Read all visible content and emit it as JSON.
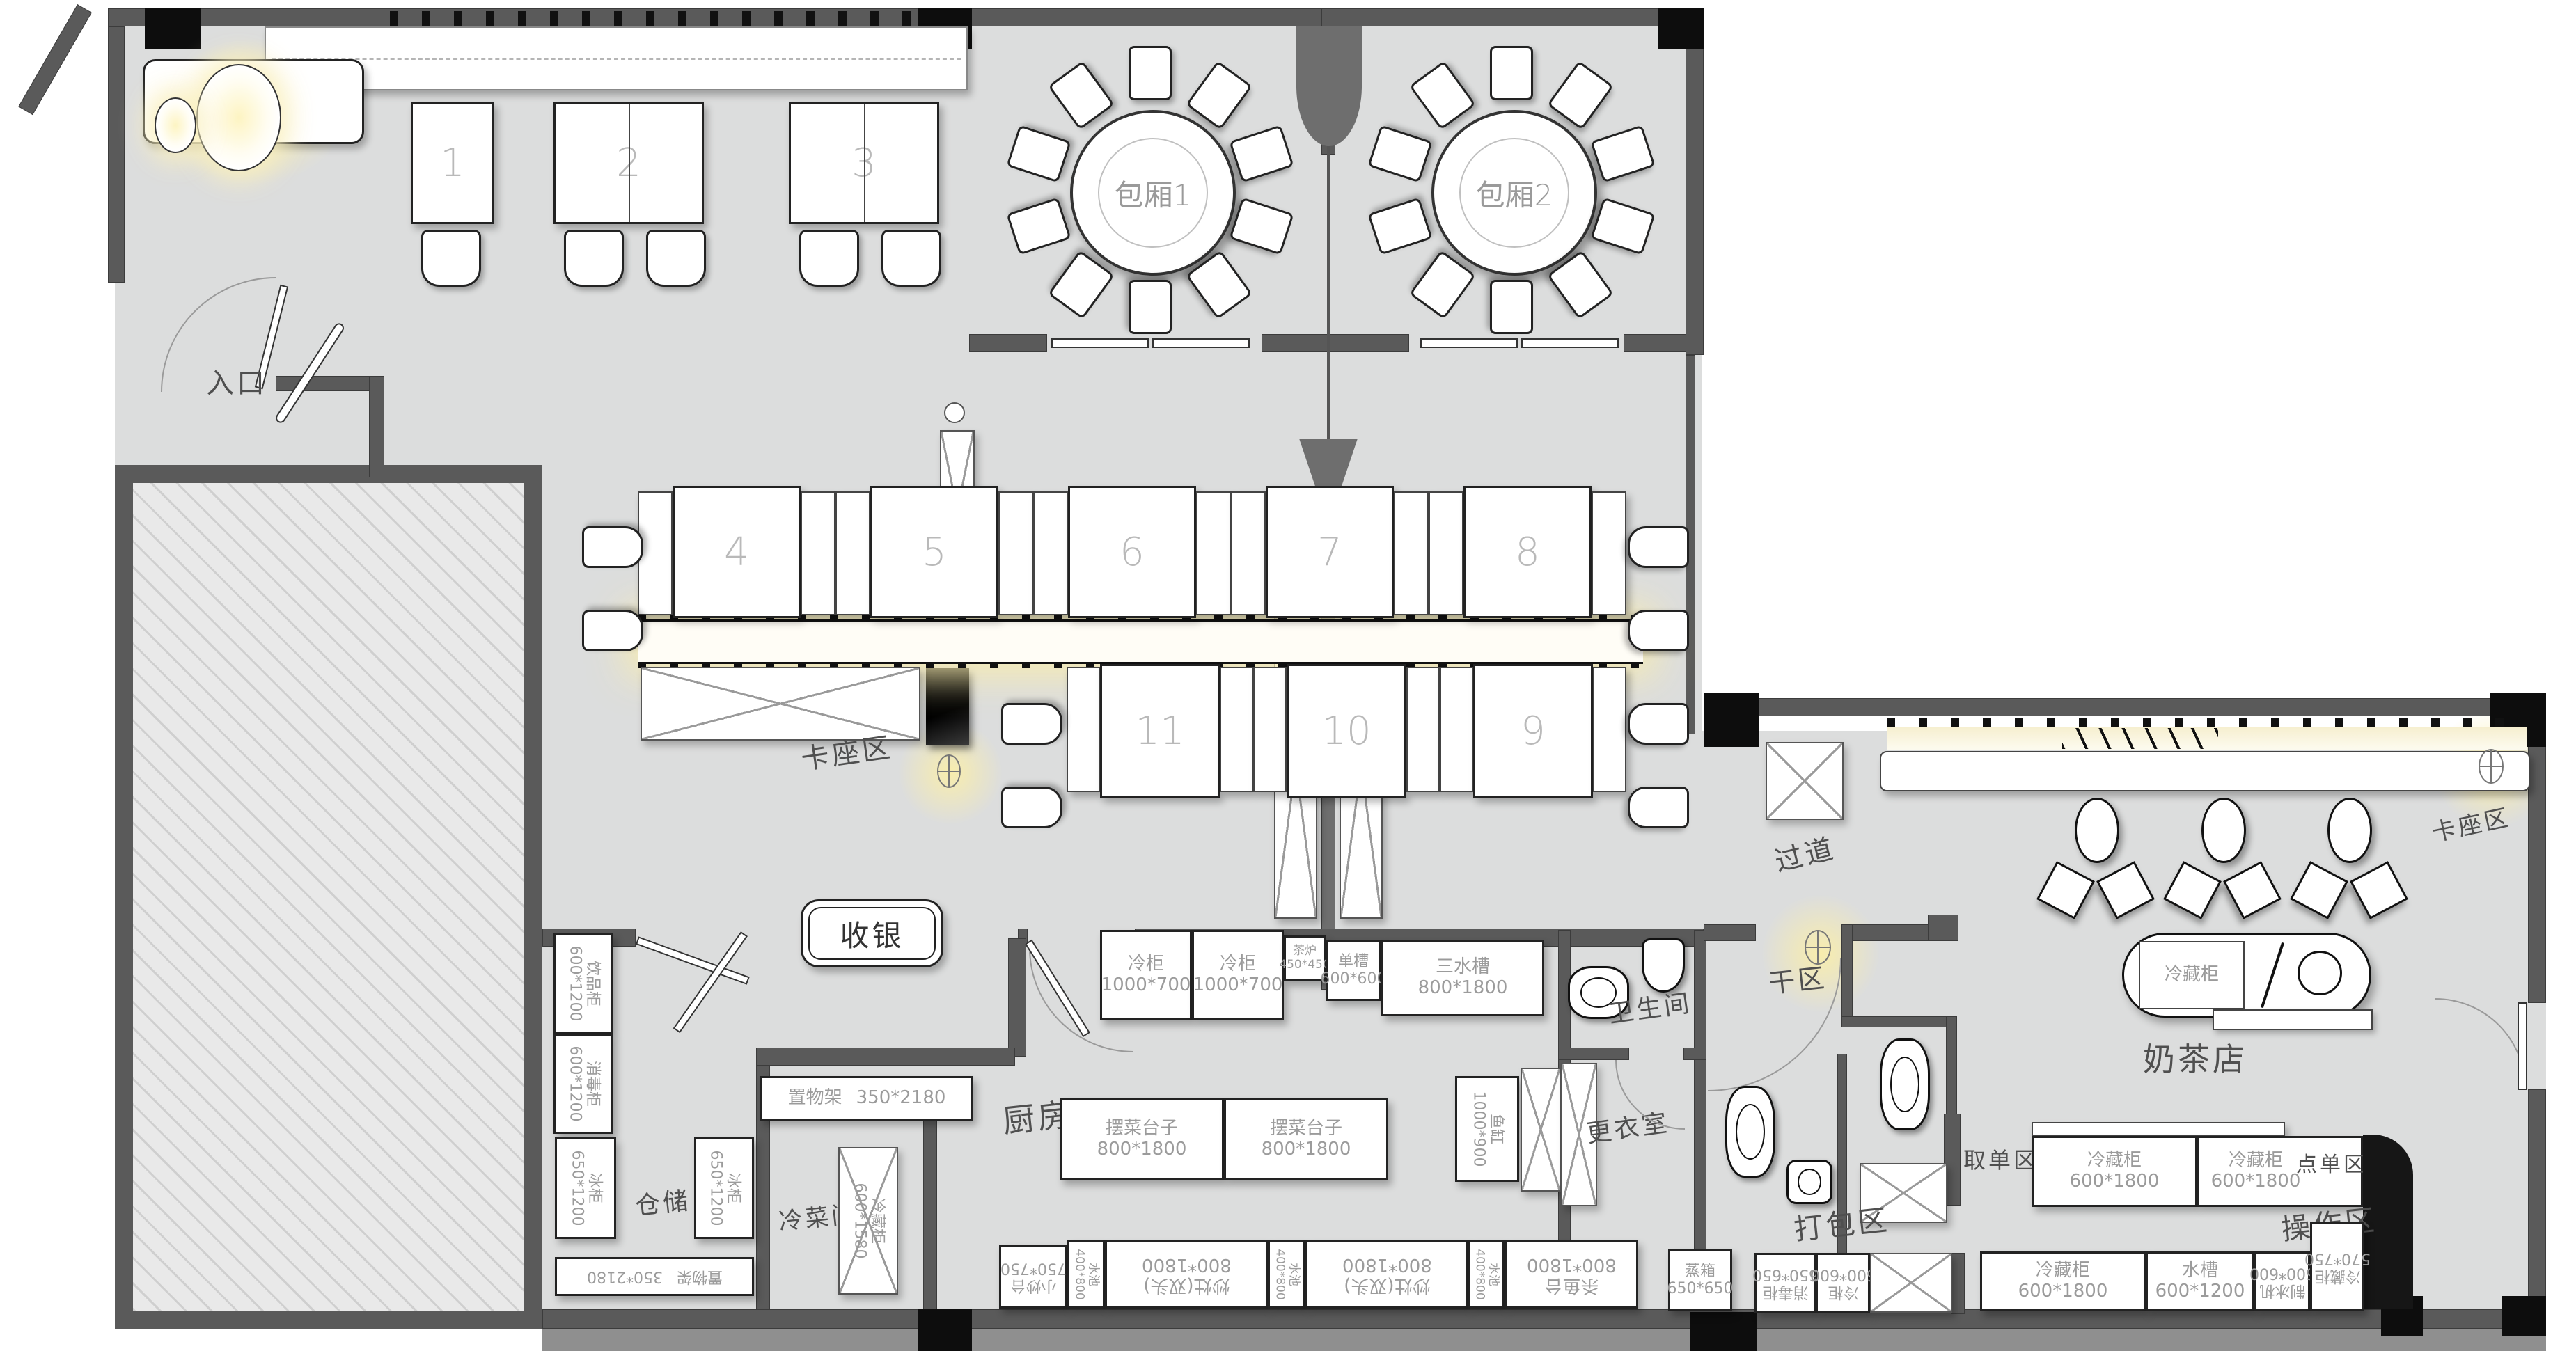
{
  "areas": {
    "entrance": "入口",
    "cashier": "收银",
    "booth_left": "卡座区",
    "booth_right": "卡座区",
    "corridor": "过道",
    "kitchen": "厨房",
    "storage": "仓储",
    "cold_dish_room": "冷菜间",
    "toilet": "卫生间",
    "changing_room": "更衣室",
    "dry_area": "干区",
    "milk_tea_shop": "奶茶店",
    "packing_area": "打包区",
    "operation_area": "操作区",
    "pickup_area": "取单区",
    "order_area": "点单区"
  },
  "private_rooms": {
    "room1": "包厢1",
    "room2": "包厢2"
  },
  "tables": {
    "t1": "1",
    "t2": "2",
    "t3": "3",
    "t4": "4",
    "t5": "5",
    "t6": "6",
    "t7": "7",
    "t8": "8",
    "t9": "9",
    "t10": "10",
    "t11": "11"
  },
  "equipment": {
    "cold_cab_a": {
      "label": "冷柜",
      "dims": "1000*700"
    },
    "cold_cab_b": {
      "label": "冷柜",
      "dims": "1000*700"
    },
    "tea_stove": {
      "label": "茶炉",
      "dims": "450*450"
    },
    "single_sink": {
      "label": "单槽",
      "dims": "600*600"
    },
    "triple_sink": {
      "label": "三水槽",
      "dims": "800*1800"
    },
    "shelf_kitchen": {
      "label": "置物架",
      "dims": "350*2180"
    },
    "plating_table_a": {
      "label": "摆菜台子",
      "dims": "800*1800"
    },
    "plating_table_b": {
      "label": "摆菜台子",
      "dims": "800*1800"
    },
    "fish_tank": {
      "label": "鱼缸",
      "dims": "1000*900"
    },
    "drink_cabinet": {
      "label": "饮品柜",
      "dims": "600*1200"
    },
    "disinfect_cab_storage": {
      "label": "消毒柜",
      "dims": "600*1200"
    },
    "freezer_a": {
      "label": "冰柜",
      "dims": "650*1200"
    },
    "freezer_b": {
      "label": "冰柜",
      "dims": "650*1200"
    },
    "shelf_storage": {
      "label": "置物架",
      "dims": "350*2180"
    },
    "cold_cab_colddish": {
      "label": "冷藏柜",
      "dims": "600*1580"
    },
    "stirfry_small": {
      "label": "小炒台",
      "dims": "750*750"
    },
    "sink_strip_a": {
      "label": "水池",
      "dims": "400*800"
    },
    "sink_strip_b": {
      "label": "水池",
      "dims": "400*800"
    },
    "sink_strip_c": {
      "label": "水池",
      "dims": "400*800"
    },
    "wok_stove_a": {
      "label": "炒灶(双头)",
      "dims": "800*1800"
    },
    "wok_stove_b": {
      "label": "炒灶(双头)",
      "dims": "800*1800"
    },
    "fish_station": {
      "label": "杀鱼台",
      "dims": "800*1800"
    },
    "steam_box": {
      "label": "蒸箱",
      "dims": "650*650"
    },
    "disinfect_cab_pack": {
      "label": "消毒柜",
      "dims": "650*650"
    },
    "cold_cab_small": {
      "label": "冷柜",
      "dims": "600*600"
    },
    "fridge_operation": {
      "label": "冷藏柜",
      "dims": "600*1800"
    },
    "sink_operation": {
      "label": "水槽",
      "dims": "600*1200"
    },
    "ice_maker": {
      "label": "制冰机",
      "dims": "600*600"
    },
    "fridge_corner": {
      "label": "冷藏柜",
      "dims": "570*750"
    },
    "fridge_counter": {
      "label": "冷藏柜",
      "dims": ""
    },
    "pickup_fridge_a": {
      "label": "冷藏柜",
      "dims": "600*1800"
    },
    "pickup_fridge_b": {
      "label": "冷藏柜",
      "dims": "600*1800"
    }
  }
}
